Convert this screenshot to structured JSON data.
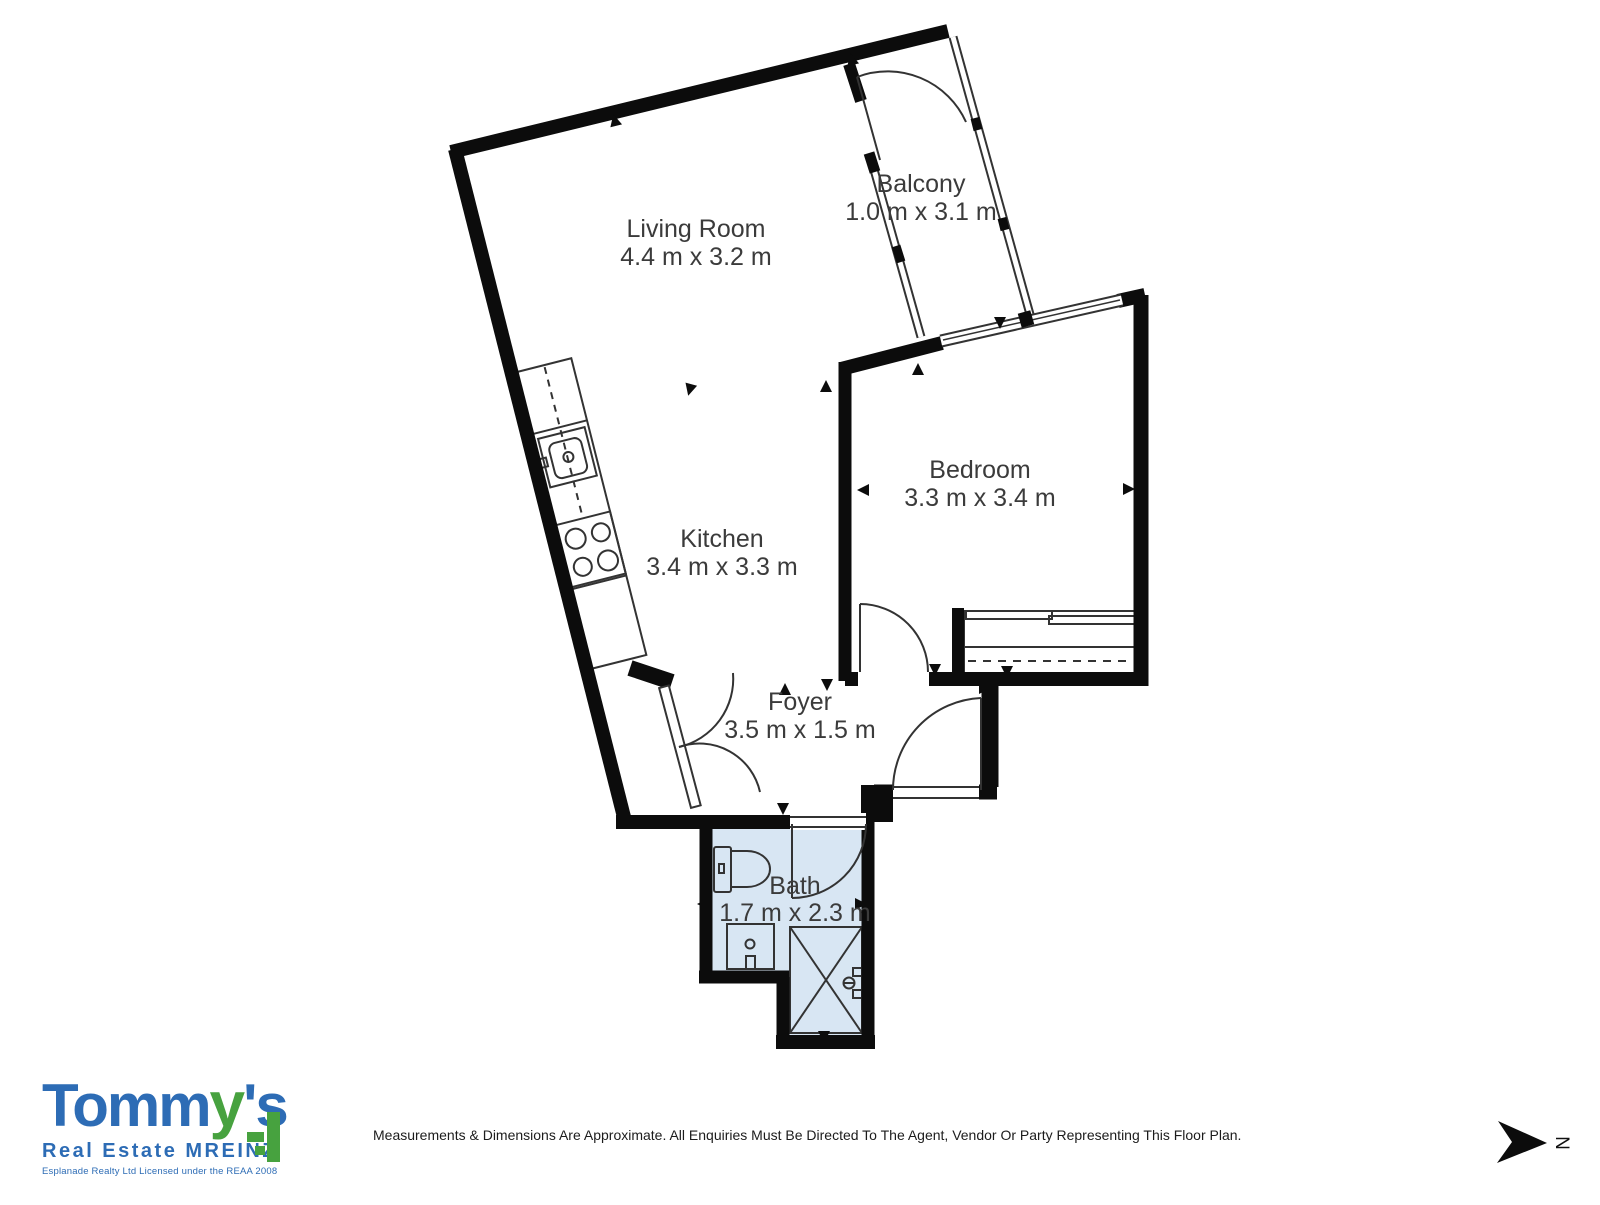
{
  "floor_plan": {
    "rooms": {
      "living_room": {
        "name": "Living Room",
        "dims": "4.4 m x 3.2 m"
      },
      "balcony": {
        "name": "Balcony",
        "dims": "1.0 m x 3.1 m"
      },
      "bedroom": {
        "name": "Bedroom",
        "dims": "3.3 m x 3.4 m"
      },
      "kitchen": {
        "name": "Kitchen",
        "dims": "3.4 m x 3.3 m"
      },
      "foyer": {
        "name": "Foyer",
        "dims": "3.5 m x 1.5 m"
      },
      "bath": {
        "name": "Bath",
        "dims": "1.7 m x 2.3 m"
      }
    },
    "north_label": "N"
  },
  "branding": {
    "brand_part1": "Tomm",
    "brand_part2": "y",
    "brand_part3": "'s",
    "subtitle": "Real Estate MREINZ",
    "tagline": "Esplanade Realty Ltd Licensed under the REAA 2008"
  },
  "footer": {
    "disclaimer": "Measurements & Dimensions Are Approximate. All Enquiries Must Be Directed To The Agent, Vendor Or Party Representing This Floor Plan."
  },
  "colors": {
    "bath_fill": "#d8e6f3",
    "wall": "#0c0c0c",
    "line": "#333333",
    "room_text": "#3b3b3b",
    "brand_blue": "#2d6cb5",
    "brand_green": "#47a23f"
  }
}
